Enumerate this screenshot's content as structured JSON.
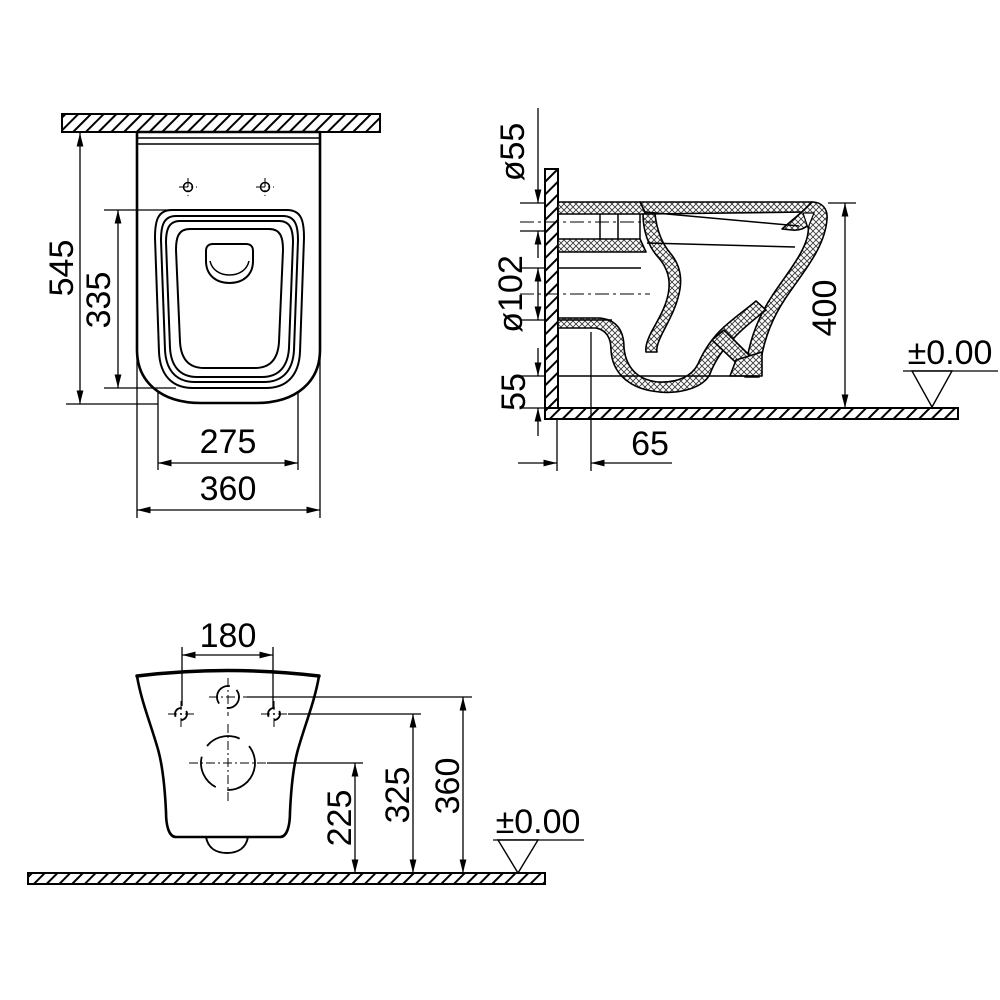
{
  "colors": {
    "line": "#000000",
    "background": "#ffffff"
  },
  "plan": {
    "total_depth": "545",
    "inner_depth": "335",
    "inner_width": "275",
    "total_width": "360"
  },
  "side": {
    "inlet_diameter": "ø55",
    "outlet_diameter": "ø102",
    "under_clearance": "55",
    "outlet_distance": "65",
    "rim_height": "400",
    "floor_datum": "±0.00"
  },
  "rear": {
    "fixing_hole_spacing": "180",
    "outlet_center_height": "225",
    "fixing_hole_height": "325",
    "inlet_center_height": "360",
    "floor_datum": "±0.00"
  }
}
